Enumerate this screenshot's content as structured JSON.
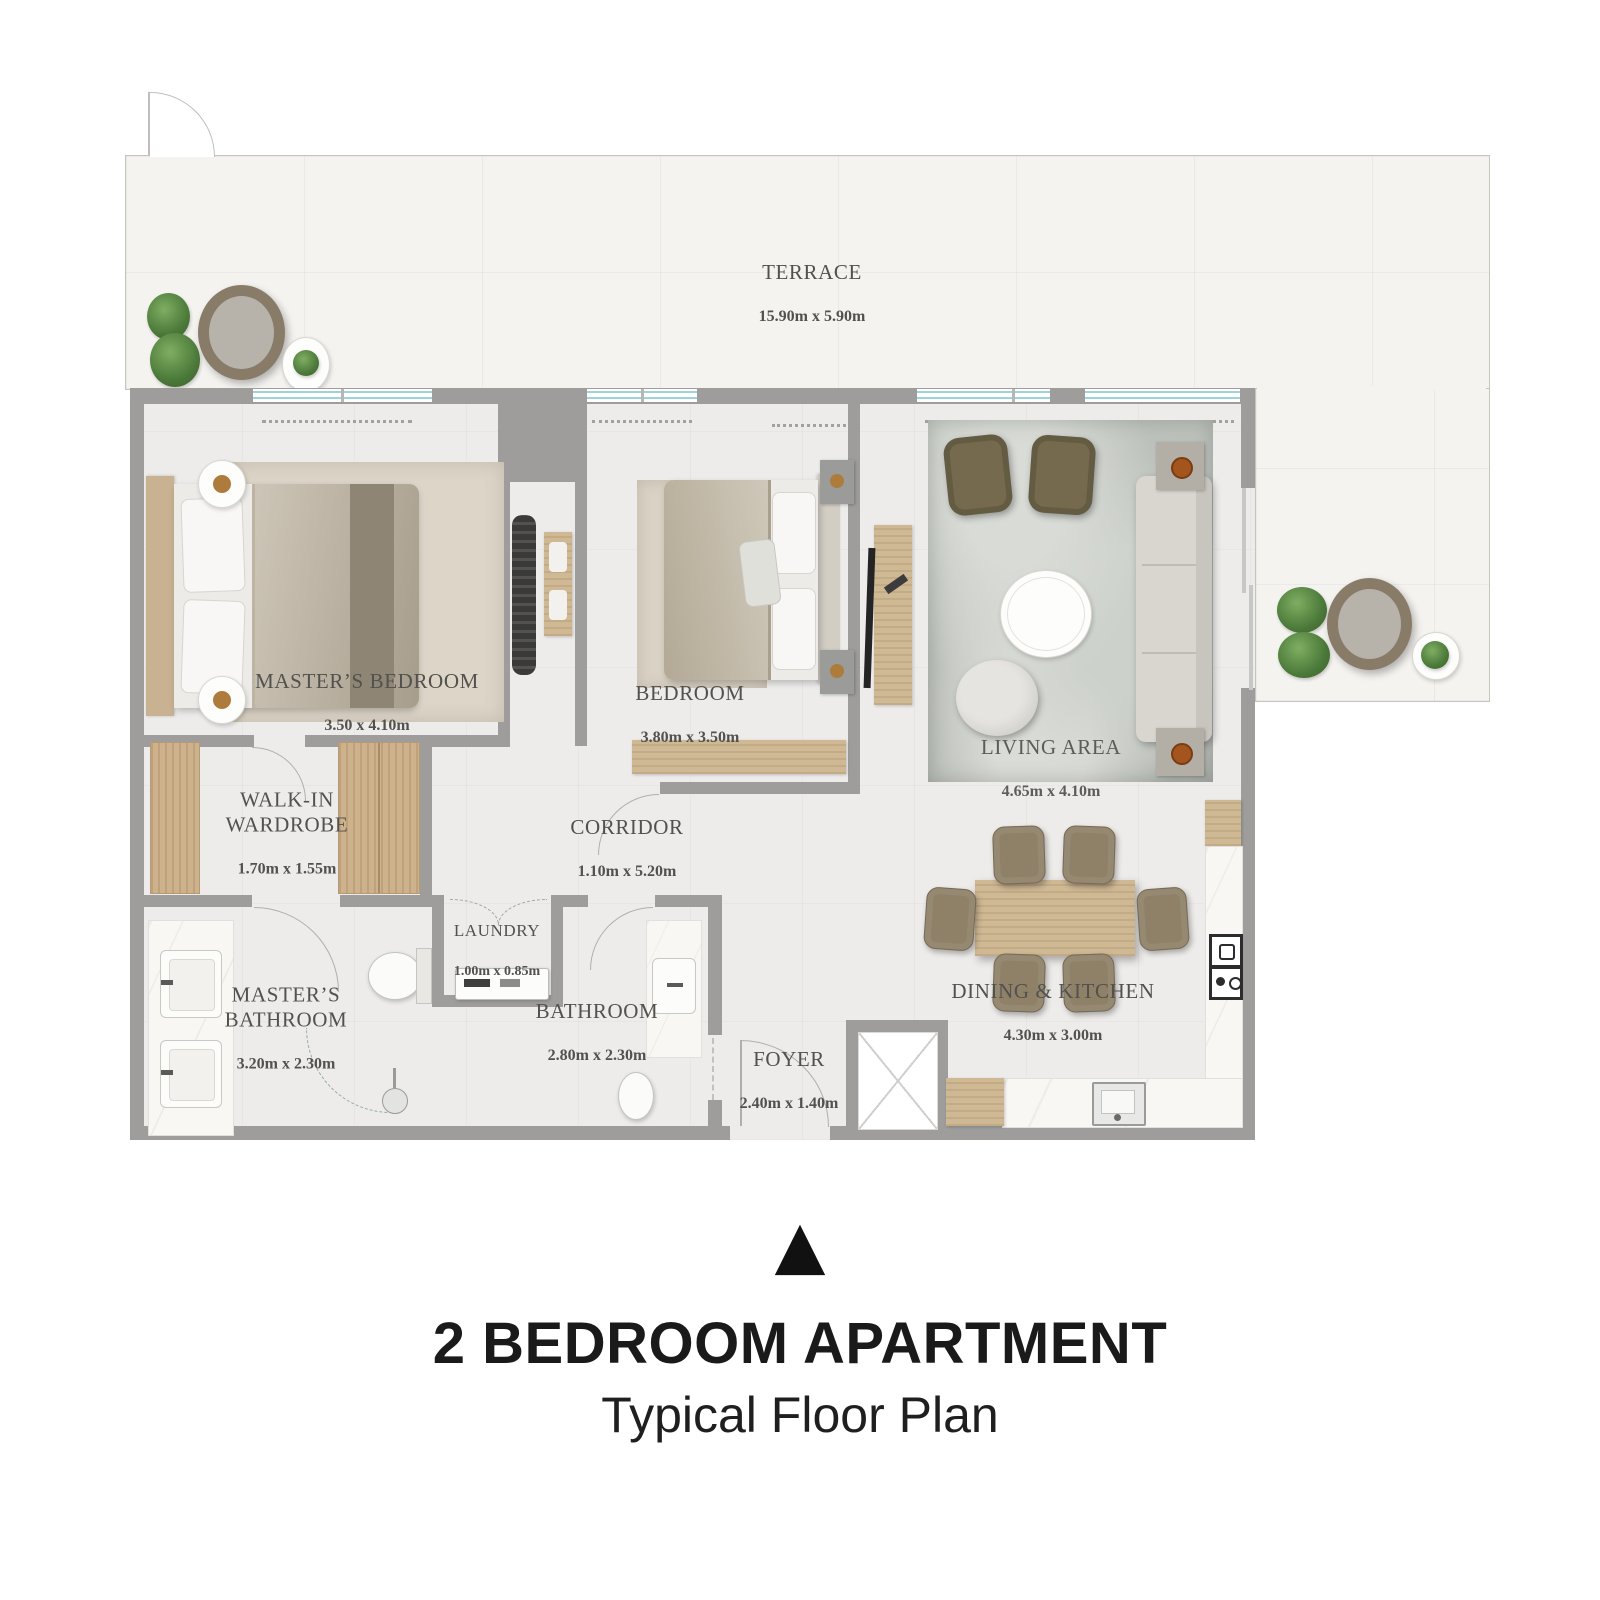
{
  "plan": {
    "title": "2 BEDROOM APARTMENT",
    "subtitle": "Typical Floor Plan",
    "north_arrow_glyph": "▲"
  },
  "rooms": [
    {
      "id": "terrace",
      "name": "TERRACE",
      "dims": "15.90m x 5.90m"
    },
    {
      "id": "masters-bedroom",
      "name": "MASTER’S BEDROOM",
      "dims": "3.50 x 4.10m"
    },
    {
      "id": "bedroom",
      "name": "BEDROOM",
      "dims": "3.80m x 3.50m"
    },
    {
      "id": "living-area",
      "name": "LIVING AREA",
      "dims": "4.65m x 4.10m"
    },
    {
      "id": "walk-in-wardrobe",
      "name": "WALK-IN WARDROBE",
      "dims": "1.70m x 1.55m"
    },
    {
      "id": "corridor",
      "name": "CORRIDOR",
      "dims": "1.10m x 5.20m"
    },
    {
      "id": "laundry",
      "name": "LAUNDRY",
      "dims": "1.00m x 0.85m"
    },
    {
      "id": "masters-bathroom",
      "name": "MASTER’S BATHROOM",
      "dims": "3.20m x 2.30m"
    },
    {
      "id": "bathroom",
      "name": "BATHROOM",
      "dims": "2.80m x 2.30m"
    },
    {
      "id": "foyer",
      "name": "FOYER",
      "dims": "2.40m x 1.40m"
    },
    {
      "id": "dining-kitchen",
      "name": "DINING & KITCHEN",
      "dims": "4.30m x 3.00m"
    }
  ],
  "colors": {
    "wall": "#9e9d9b",
    "terrace_floor": "#f4f3f0",
    "apartment_floor": "#edecea",
    "window_glass": "#9fd3dc",
    "wood": "#cfb894",
    "plant_green": "#4c7a3a",
    "label_text": "#52514d",
    "title_text": "#1a1a1a"
  }
}
